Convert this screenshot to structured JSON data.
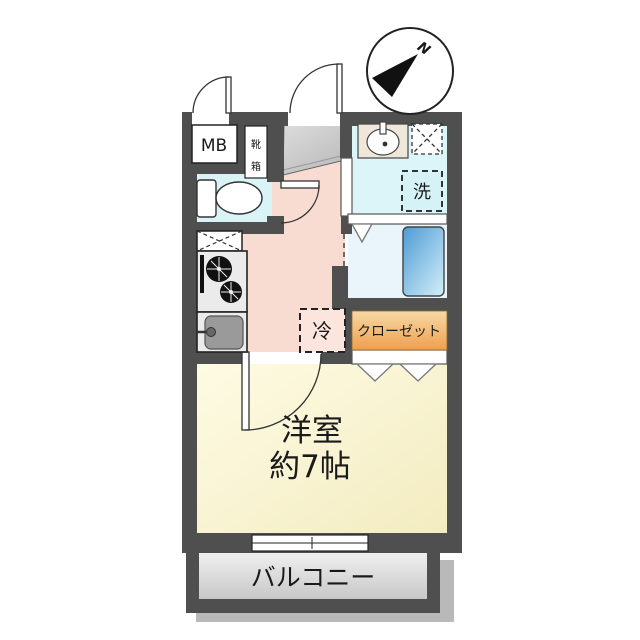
{
  "plan": {
    "type": "apartment-floor-plan"
  },
  "labels": {
    "meter_box": "MB",
    "shoe_box_char1": "靴",
    "shoe_box_char2": "箱",
    "wash_machine": "洗",
    "fridge": "冷",
    "closet": "クローゼット",
    "room_name": "洋室",
    "room_size": "約7帖",
    "balcony": "バルコニー",
    "compass_north": "N"
  },
  "colors": {
    "wall": "#4F4F4F",
    "outline": "#222222",
    "toilet_floor": "#D9F3F7",
    "washroom_floor": "#DCF5F8",
    "bathroom_floor": "#E9F5FA",
    "kitchen_floor": "#F8DCD2",
    "fridge_box": "#FBE5DC",
    "wash_box": "#D5F3F7",
    "room_light": "#FEFBE4",
    "room_dark": "#F3ECC1",
    "closet_top": "#F7D9A4",
    "closet_bottom": "#EE9F4F",
    "tub_dark": "#4E9BD3",
    "tub_light": "#CDEBF8",
    "genkan_light": "#DCDCDC",
    "genkan_dark": "#BDBDBD",
    "balcony_light": "#EFEFEF",
    "balcony_dark": "#C8C8C8",
    "shadow": "#B9B9B9",
    "counter_gray": "#EBEBEB",
    "basin_beige": "#EFE8DA"
  }
}
